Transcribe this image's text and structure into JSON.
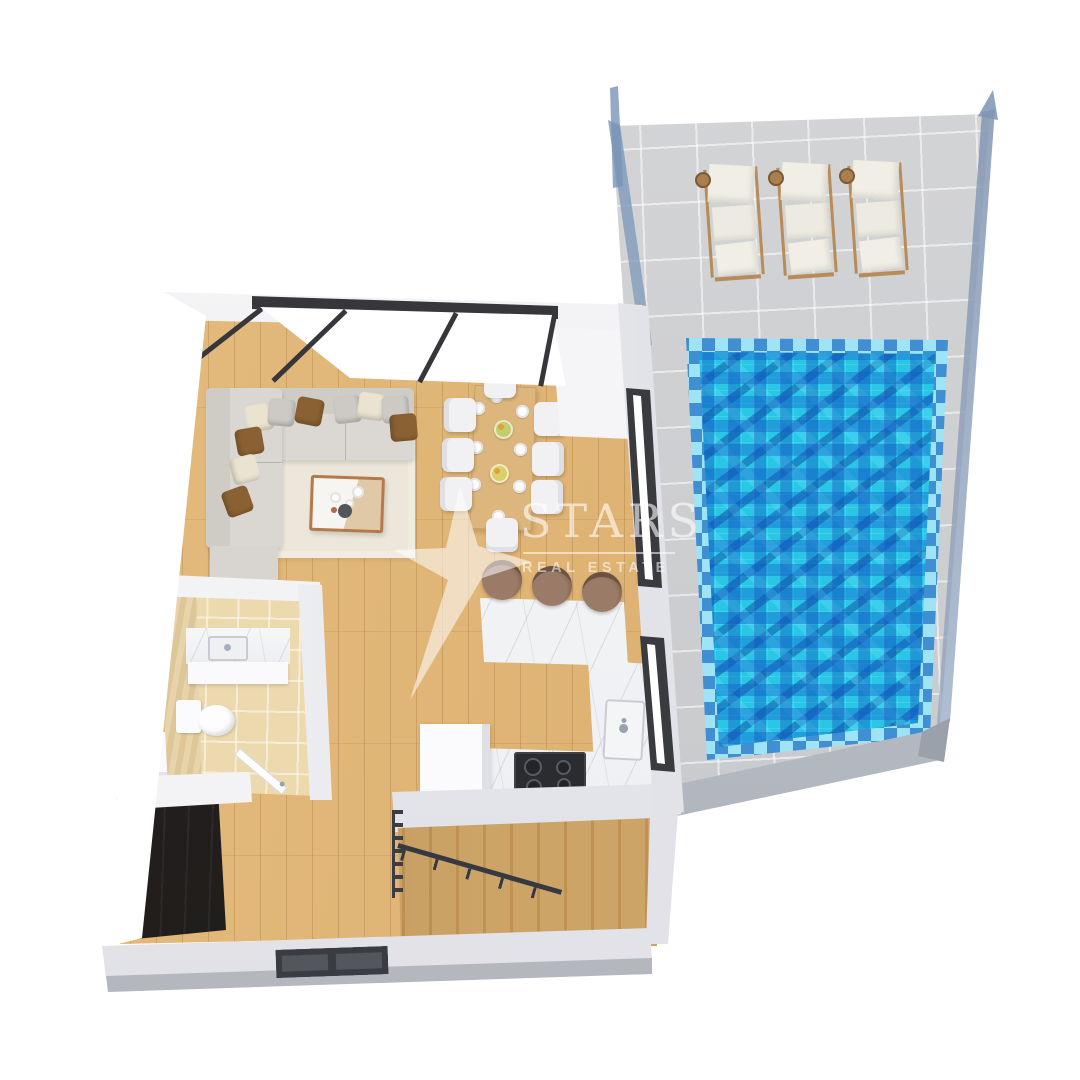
{
  "watermark": {
    "title": "STARS",
    "subtitle": "REAL ESTATE"
  },
  "counts": {
    "sun_loungers": 3,
    "dining_chairs": 8,
    "dining_plates": 8,
    "fruit_bowls": 2,
    "bar_stools": 3,
    "cooktop_burners": 4,
    "sofa_pillows": 10,
    "window_panes": 3
  },
  "palette": {
    "background": "#ffffff",
    "terrace_tile": "#cbccce",
    "pool_water": "#29c6e6",
    "pool_tile_dark": "#1b55b0",
    "pool_tile_mid": "#2e7fd4",
    "pool_border_light": "#9fe3f6",
    "glass_railing": "#7e9cbd",
    "lounger_cushion": "#efede3",
    "lounger_frame": "#b78c58",
    "wood_floor": "#e0b577",
    "wall_white": "#f2f2f5",
    "window_frame": "#36373b",
    "sofa": "#d7d4cf",
    "pillow_brown": "#8a6132",
    "pillow_cream": "#eae3d0",
    "rug": "#ece7da",
    "dining_table": "#dcb67c",
    "chair_white": "#f1f1f3",
    "marble_counter": "#f5f5f7",
    "cooktop_black": "#2b2c30",
    "stool_brown": "#8f7260",
    "bathroom_floor": "#ecd9ae",
    "stair_wood": "#c89d60",
    "railing_dark": "#3a3d42",
    "closet_dark": "#26211f",
    "watermark_white": "#ffffff"
  },
  "scene_features": [
    "pool-terrace",
    "swimming-pool",
    "sun-loungers",
    "glass-railing",
    "living-room",
    "sectional-sofa",
    "coffee-table",
    "area-rug",
    "dining-table",
    "kitchen-counters",
    "breakfast-bar",
    "bathroom",
    "staircase",
    "entry-closet"
  ]
}
